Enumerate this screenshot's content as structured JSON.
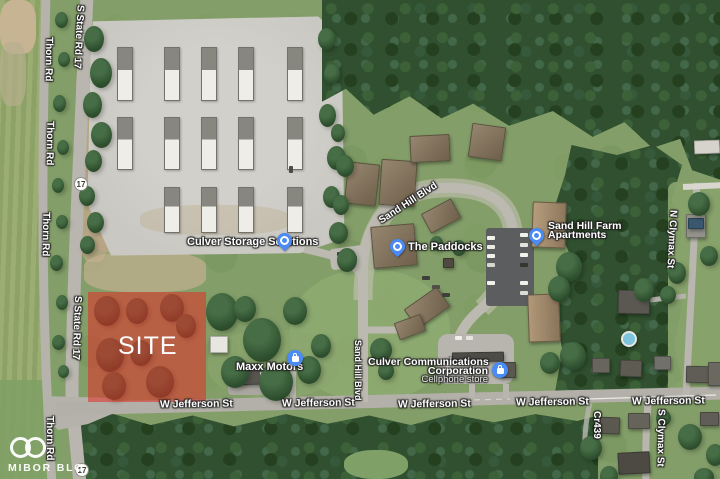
{
  "map": {
    "site": {
      "label": "SITE"
    },
    "watermark": {
      "text": "MIBOR BLC"
    },
    "route_shields": [
      {
        "number": "17"
      },
      {
        "number": "17"
      }
    ],
    "street_labels": [
      "W Jefferson St",
      "W Jefferson St",
      "W Jefferson St",
      "W Jefferson St",
      "W Jefferson St"
    ],
    "road_labels": [
      {
        "text": "S State Rd 17"
      },
      {
        "text": "Thorn Rd"
      },
      {
        "text": "Thorn Rd"
      },
      {
        "text": "Thorn Rd"
      },
      {
        "text": "S State Rd 17"
      },
      {
        "text": "Thorn Rd"
      },
      {
        "text": "Sand Hill Blvd"
      },
      {
        "text": "Sand Hill Blvd"
      },
      {
        "text": "N Clymax St"
      },
      {
        "text": "S Clymax St"
      },
      {
        "text": "Cr439"
      }
    ],
    "places": [
      {
        "name": "Culver Storage Solutions",
        "icon": "place-pin"
      },
      {
        "name": "The Paddocks",
        "icon": "place-pin"
      },
      {
        "name": "Sand Hill Farm",
        "name2": "Apartments",
        "icon": "place-pin"
      },
      {
        "name": "Maxx Motors",
        "icon": "shopping-pin"
      },
      {
        "name": "Culver Communications",
        "name2": "Corporation",
        "subtitle": "Cellphone store",
        "icon": "shopping-pin"
      }
    ],
    "colors": {
      "site_overlay": "#e32d26",
      "poi_pin": "#4a8bf5",
      "label_text": "#ffffff"
    }
  }
}
